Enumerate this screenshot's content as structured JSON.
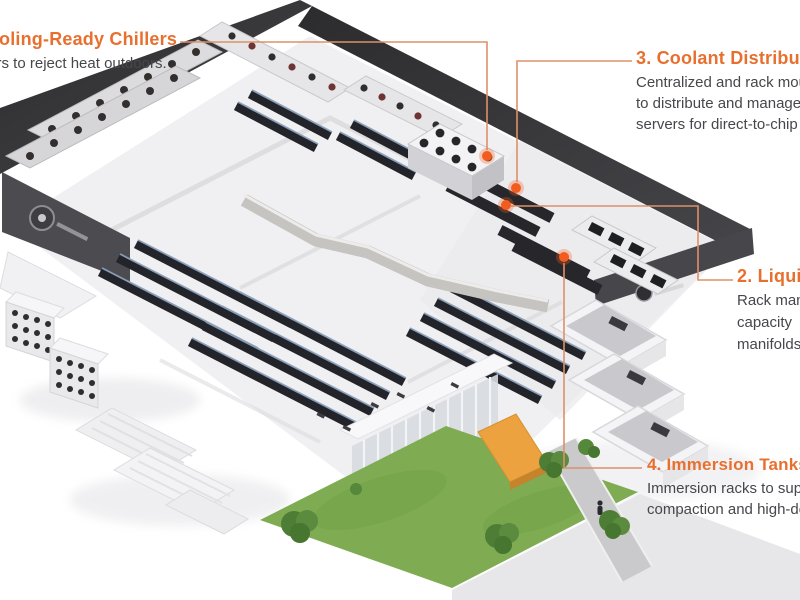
{
  "figure": {
    "description": "Isometric cutaway illustration of a liquid-cooled data center with numbered orange callouts"
  },
  "colors": {
    "accent": "#e8702f",
    "body_text": "#46474b",
    "connector_line": "#de9069",
    "marker_dot": "#f25c1f",
    "roof_dark": "#343336",
    "lawn_green": "#7fac52",
    "rack_dark": "#23242a",
    "rack_rail_blue": "#8ba2bc",
    "canopy_orange": "#eca23e"
  },
  "callouts": [
    {
      "number": "1",
      "title": "1. Cooling-Ready Chillers",
      "body_lines": [
        "Chillers to reject heat outdoors."
      ]
    },
    {
      "number": "2",
      "title": "2. Liquid",
      "body_lines": [
        "Rack man",
        "capacity",
        "manifolds"
      ]
    },
    {
      "number": "3",
      "title": "3. Coolant Distribution",
      "body_lines": [
        "Centralized and rack mou",
        "to distribute and manage",
        "servers for direct-to-chip"
      ]
    },
    {
      "number": "4",
      "title": "4. Immersion Tanks",
      "body_lines": [
        "Immersion racks to supp",
        "compaction and high-de"
      ]
    }
  ]
}
